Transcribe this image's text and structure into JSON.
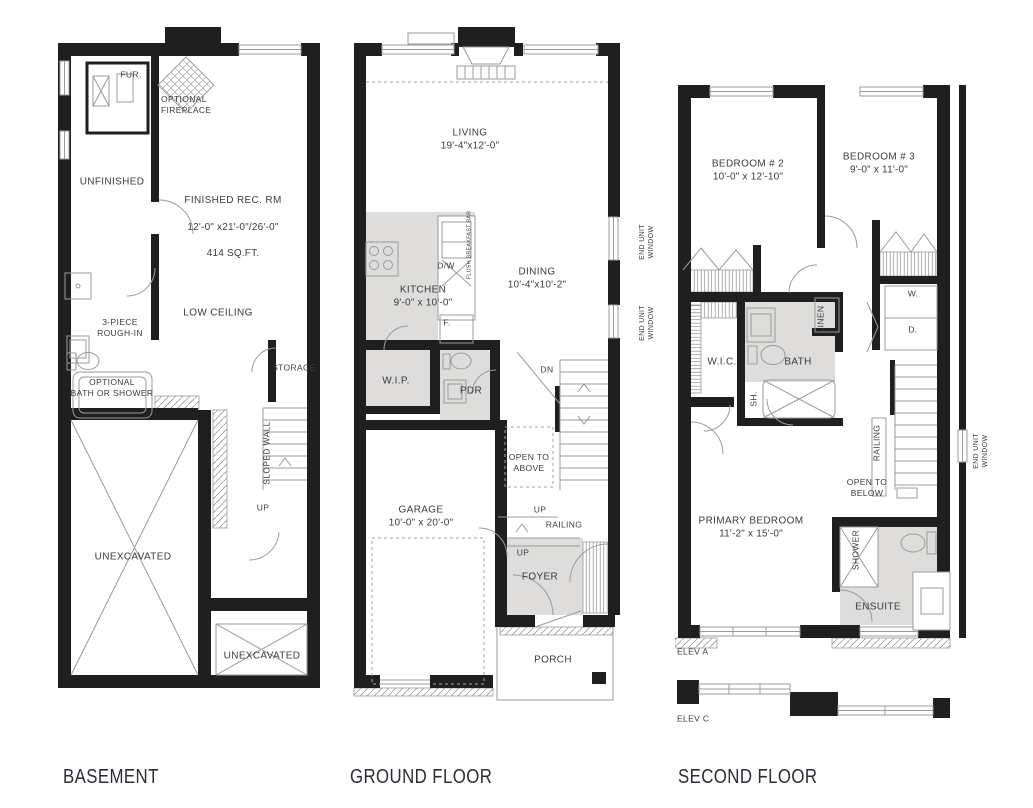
{
  "colors": {
    "wall": "#1f1f1f",
    "thin_line": "#9b9b9b",
    "room_fill": "#dedddb",
    "text": "#3c3c3c",
    "title": "#2c2c34"
  },
  "titles": {
    "basement": "BASEMENT",
    "ground": "GROUND FLOOR",
    "second": "SECOND FLOOR"
  },
  "basement": {
    "fur": "FUR.",
    "optional_fireplace": "OPTIONAL\nFIREPLACE",
    "unfinished": "UNFINISHED",
    "rec_room": "FINISHED REC. RM",
    "rec_room_dims": "12'-0\" x21'-0\"/26'-0\"",
    "rec_room_area": "414 SQ.FT.",
    "low_ceiling": "LOW CEILING",
    "rough_in": "3-PIECE\nROUGH-IN",
    "optional_bath": "OPTIONAL\nBATH OR SHOWER",
    "storage": "STORAGE",
    "sloped_wall": "SLOPED WALL",
    "up": "UP",
    "unexcavated": "UNEXCAVATED",
    "unexcavated_2": "UNEXCAVATED"
  },
  "ground": {
    "living": "LIVING",
    "living_dims": "19'-4\"x12'-0\"",
    "kitchen": "KITCHEN",
    "kitchen_dims": "9'-0\" x 10'-0\"",
    "dining": "DINING",
    "dining_dims": "10'-4\"x10'-2\"",
    "dw": "D/W",
    "flush_bar": "FLUSH BREAKFAST BAR",
    "fridge": "F.",
    "wip": "W.I.P.",
    "pdr": "PDR",
    "dn": "DN",
    "open_to_above": "OPEN TO\nABOVE",
    "up_stair": "UP",
    "railing": "RAILING",
    "up_foyer": "UP",
    "garage": "GARAGE",
    "garage_dims": "10'-0\" x 20'-0\"",
    "foyer": "FOYER",
    "porch": "PORCH",
    "end_unit_window_upper": "END UNIT\nWINDOW",
    "end_unit_window_lower": "END UNIT\nWINDOW"
  },
  "second": {
    "bedroom2": "BEDROOM # 2",
    "bedroom2_dims": "10'-0\" x 12'-10\"",
    "bedroom3": "BEDROOM # 3",
    "bedroom3_dims": "9'-0\" x 11'-0\"",
    "washer": "W.",
    "dryer": "D.",
    "wic": "W.I.C.",
    "bath": "BATH",
    "linen": "LINEN",
    "sh": "SH.",
    "railing": "RAILING",
    "open_to_below": "OPEN TO\nBELOW",
    "primary": "PRIMARY BEDROOM",
    "primary_dims": "11'-2\" x 15'-0\"",
    "shower": "SHOWER",
    "ensuite": "ENSUITE",
    "end_unit_window": "END UNIT\nWINDOW",
    "elev_a": "ELEV A",
    "elev_c": "ELEV C"
  }
}
